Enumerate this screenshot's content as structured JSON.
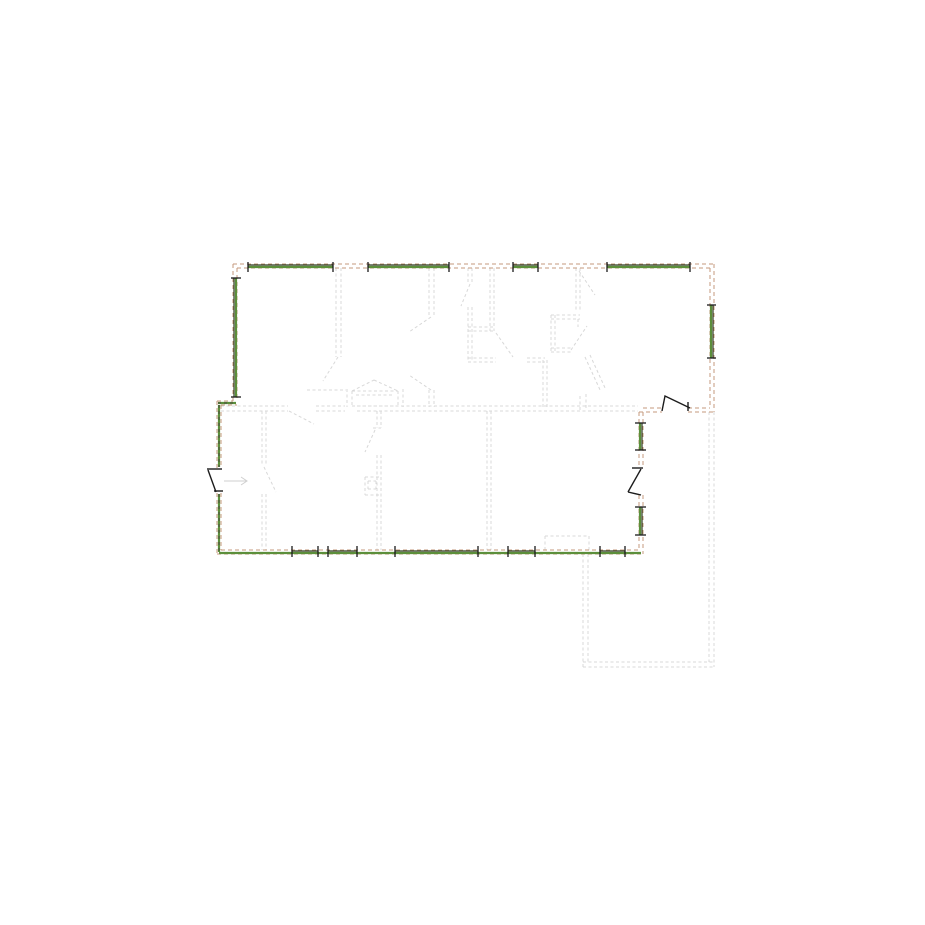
{
  "palette": {
    "background": "#ffffff",
    "wall_tan": "#c49a7c",
    "window_green": "#5c8f3b",
    "window_frame_dark": "#2f3a20",
    "underlay_gray": "#d8d8d8",
    "door_black": "#1c1c1c",
    "highlight_dash_dark": "#4d4d42",
    "arrow_gray": "#cfcfcf"
  },
  "canvas": {
    "width": 925,
    "height": 925
  },
  "layers": {
    "underlay": {
      "color": "#d8d8d8",
      "width": 1,
      "dash": "3 2.5",
      "lines": [
        [
          336,
          268,
          336,
          357
        ],
        [
          341,
          268,
          341,
          357
        ],
        [
          338,
          357,
          323,
          381
        ],
        [
          307,
          390,
          346,
          390
        ],
        [
          352,
          391,
          398,
          391
        ],
        [
          352,
          391,
          352,
          406
        ],
        [
          398,
          391,
          398,
          406
        ],
        [
          352,
          406,
          398,
          406
        ],
        [
          356,
          395,
          394,
          395
        ],
        [
          352,
          391,
          374,
          380
        ],
        [
          374,
          380,
          398,
          391
        ],
        [
          347,
          389,
          347,
          407
        ],
        [
          403,
          389,
          403,
          407
        ],
        [
          429,
          268,
          429,
          317
        ],
        [
          434,
          268,
          434,
          317
        ],
        [
          431,
          317,
          409,
          332
        ],
        [
          431,
          390,
          409,
          375
        ],
        [
          429,
          390,
          429,
          407
        ],
        [
          434,
          390,
          434,
          407
        ],
        [
          468,
          268,
          468,
          284
        ],
        [
          472,
          268,
          472,
          284
        ],
        [
          470,
          284,
          461,
          306
        ],
        [
          468,
          307,
          468,
          362
        ],
        [
          472,
          307,
          472,
          362
        ],
        [
          468,
          327,
          494,
          327
        ],
        [
          468,
          331,
          494,
          331
        ],
        [
          490,
          268,
          490,
          331
        ],
        [
          494,
          268,
          494,
          331
        ],
        [
          468,
          358,
          496,
          358
        ],
        [
          468,
          362,
          496,
          362
        ],
        [
          527,
          358,
          545,
          358
        ],
        [
          527,
          362,
          545,
          362
        ],
        [
          496,
          333,
          513,
          357
        ],
        [
          543,
          360,
          543,
          407
        ],
        [
          547,
          360,
          547,
          407
        ],
        [
          576,
          268,
          576,
          310
        ],
        [
          580,
          268,
          580,
          310
        ],
        [
          579,
          271,
          595,
          295
        ],
        [
          551,
          315,
          580,
          315
        ],
        [
          551,
          319,
          580,
          319
        ],
        [
          551,
          315,
          551,
          352
        ],
        [
          555,
          315,
          555,
          352
        ],
        [
          551,
          348,
          571,
          348
        ],
        [
          551,
          352,
          571,
          352
        ],
        [
          571,
          350,
          587,
          326
        ],
        [
          578,
          319,
          578,
          327
        ],
        [
          585,
          357,
          601,
          392
        ],
        [
          590,
          355,
          606,
          390
        ],
        [
          580,
          396,
          580,
          410
        ],
        [
          586,
          394,
          586,
          410
        ],
        [
          221,
          406,
          288,
          406
        ],
        [
          221,
          411,
          288,
          411
        ],
        [
          316,
          406,
          345,
          406
        ],
        [
          316,
          411,
          345,
          411
        ],
        [
          357,
          406,
          638,
          406
        ],
        [
          357,
          411,
          638,
          411
        ],
        [
          289,
          411,
          314,
          424
        ],
        [
          262,
          411,
          262,
          465
        ],
        [
          266,
          411,
          266,
          465
        ],
        [
          264,
          467,
          276,
          492
        ],
        [
          262,
          494,
          262,
          550
        ],
        [
          266,
          494,
          266,
          550
        ],
        [
          377,
          411,
          377,
          428
        ],
        [
          381,
          411,
          381,
          428
        ],
        [
          373,
          428,
          381,
          428
        ],
        [
          375,
          430,
          365,
          452
        ],
        [
          377,
          455,
          377,
          550
        ],
        [
          381,
          455,
          381,
          550
        ],
        [
          365,
          477,
          379,
          477
        ],
        [
          365,
          495,
          379,
          495
        ],
        [
          365,
          477,
          365,
          495
        ],
        [
          368,
          481,
          376,
          481
        ],
        [
          368,
          489,
          376,
          489
        ],
        [
          368,
          481,
          368,
          489
        ],
        [
          376,
          481,
          376,
          489
        ],
        [
          487,
          411,
          487,
          550
        ],
        [
          491,
          411,
          491,
          550
        ],
        [
          545,
          536,
          589,
          536
        ],
        [
          545,
          536,
          545,
          550
        ],
        [
          589,
          536,
          589,
          550
        ],
        [
          583,
          554,
          583,
          667
        ],
        [
          588,
          554,
          588,
          662
        ],
        [
          583,
          662,
          714,
          662
        ],
        [
          583,
          667,
          714,
          667
        ],
        [
          709,
          412,
          709,
          662
        ],
        [
          714,
          412,
          714,
          667
        ]
      ]
    },
    "walls": {
      "color": "#c49a7c",
      "width": 1,
      "dash": "4 3",
      "lines": [
        [
          233,
          264,
          714,
          264
        ],
        [
          237,
          268,
          710,
          268
        ],
        [
          233,
          264,
          233,
          401
        ],
        [
          237,
          268,
          237,
          401
        ],
        [
          714,
          264,
          714,
          412
        ],
        [
          710,
          268,
          710,
          408
        ],
        [
          217,
          401,
          233,
          401
        ],
        [
          221,
          405,
          237,
          405
        ],
        [
          217,
          401,
          217,
          468
        ],
        [
          221,
          405,
          221,
          468
        ],
        [
          217,
          493,
          217,
          554
        ],
        [
          221,
          493,
          221,
          550
        ],
        [
          217,
          554,
          643,
          554
        ],
        [
          221,
          550,
          639,
          550
        ],
        [
          643,
          412,
          643,
          467
        ],
        [
          639,
          412,
          639,
          467
        ],
        [
          643,
          495,
          643,
          554
        ],
        [
          639,
          495,
          639,
          550
        ],
        [
          643,
          408,
          662,
          408
        ],
        [
          688,
          408,
          710,
          408
        ],
        [
          639,
          412,
          662,
          412
        ],
        [
          688,
          412,
          714,
          412
        ]
      ]
    },
    "windowGreen": {
      "color": "#5c8f3b",
      "width": 2.2,
      "dash": "",
      "lines": [
        [
          248,
          267,
          333,
          267
        ],
        [
          368,
          267,
          449,
          267
        ],
        [
          513,
          267,
          538,
          267
        ],
        [
          607,
          267,
          690,
          267
        ],
        [
          236,
          278,
          236,
          397
        ],
        [
          711,
          305,
          711,
          358
        ],
        [
          640,
          423,
          640,
          450
        ],
        [
          640,
          507,
          640,
          535
        ],
        [
          219,
          553,
          641,
          553
        ],
        [
          219,
          405,
          219,
          467
        ],
        [
          219,
          494,
          219,
          552
        ],
        [
          218,
          403,
          236,
          403
        ]
      ]
    },
    "windowDark": {
      "color": "#2f3a20",
      "width": 1.2,
      "dash": "",
      "lines": [
        [
          248,
          265,
          333,
          265
        ],
        [
          368,
          265,
          449,
          265
        ],
        [
          513,
          265,
          538,
          265
        ],
        [
          607,
          265,
          690,
          265
        ],
        [
          234,
          278,
          234,
          397
        ],
        [
          713,
          305,
          713,
          358
        ],
        [
          642,
          423,
          642,
          450
        ],
        [
          642,
          507,
          642,
          535
        ],
        [
          292,
          551,
          318,
          551
        ],
        [
          328,
          551,
          357,
          551
        ],
        [
          395,
          551,
          478,
          551
        ],
        [
          508,
          551,
          535,
          551
        ],
        [
          600,
          551,
          625,
          551
        ]
      ]
    },
    "highlightDashes": {
      "color": "#4d4d42",
      "width": 1,
      "dash": "3 3",
      "lines": [
        [
          219,
          405,
          219,
          467
        ],
        [
          219,
          494,
          219,
          552
        ],
        [
          218,
          403,
          236,
          403
        ]
      ]
    },
    "ticks": {
      "color": "#1a1a1a",
      "width": 1.3,
      "dash": "",
      "lines": [
        [
          248,
          262,
          248,
          272
        ],
        [
          333,
          262,
          333,
          272
        ],
        [
          368,
          262,
          368,
          272
        ],
        [
          449,
          262,
          449,
          272
        ],
        [
          513,
          262,
          513,
          272
        ],
        [
          538,
          262,
          538,
          272
        ],
        [
          607,
          262,
          607,
          272
        ],
        [
          690,
          262,
          690,
          272
        ],
        [
          231,
          278,
          241,
          278
        ],
        [
          231,
          397,
          241,
          397
        ],
        [
          707,
          305,
          716,
          305
        ],
        [
          707,
          358,
          716,
          358
        ],
        [
          635,
          423,
          646,
          423
        ],
        [
          635,
          450,
          646,
          450
        ],
        [
          635,
          507,
          646,
          507
        ],
        [
          635,
          535,
          646,
          535
        ],
        [
          292,
          546,
          292,
          557
        ],
        [
          318,
          546,
          318,
          557
        ],
        [
          328,
          546,
          328,
          557
        ],
        [
          357,
          546,
          357,
          557
        ],
        [
          395,
          546,
          395,
          557
        ],
        [
          478,
          546,
          478,
          557
        ],
        [
          508,
          546,
          508,
          557
        ],
        [
          535,
          546,
          535,
          557
        ],
        [
          600,
          546,
          600,
          557
        ],
        [
          625,
          546,
          625,
          557
        ]
      ]
    },
    "doors": {
      "color": "#1c1c1c",
      "width": 1.4,
      "dash": "",
      "polylines": [
        [
          [
            662,
            411
          ],
          [
            665,
            396
          ],
          [
            690,
            408
          ]
        ],
        [
          [
            688,
            402
          ],
          [
            688,
            411
          ]
        ],
        [
          [
            632,
            468
          ],
          [
            643,
            468
          ]
        ],
        [
          [
            641,
            469
          ],
          [
            628,
            492
          ]
        ],
        [
          [
            628,
            492
          ],
          [
            641,
            495
          ]
        ],
        [
          [
            207,
            469
          ],
          [
            222,
            469
          ]
        ],
        [
          [
            208,
            470
          ],
          [
            216,
            492
          ]
        ],
        [
          [
            214,
            491
          ],
          [
            223,
            491
          ]
        ]
      ]
    },
    "arrow": {
      "color": "#cfcfcf",
      "width": 1,
      "dash": "",
      "lines": [
        [
          224,
          481,
          246,
          481
        ]
      ],
      "polylines": [
        [
          [
            241,
            477
          ],
          [
            247,
            481
          ],
          [
            241,
            485
          ]
        ]
      ]
    }
  }
}
